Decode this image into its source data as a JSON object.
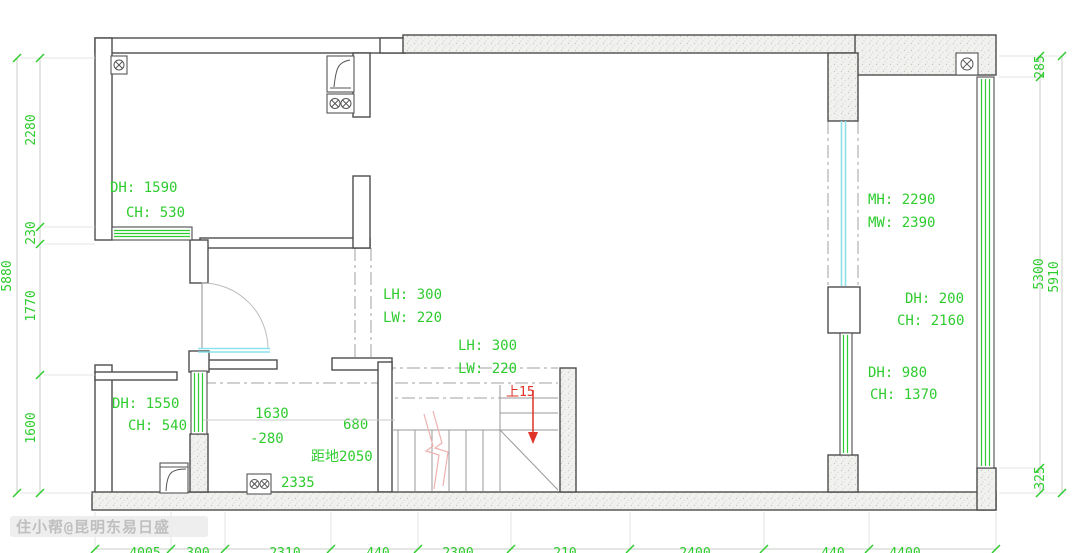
{
  "colors": {
    "annotation_green": "#2fcc2f",
    "new_window_cyan": "#8ce1ea",
    "stair_red": "#e03226",
    "break_pink": "#efb0b0",
    "wall_stroke": "#4d4d4d",
    "centerline_gray": "#a0a0a0"
  },
  "rooms": {
    "top_left_door": {
      "line1": "DH: 1590",
      "line2": "CH: 530"
    },
    "bottom_left_door": {
      "line1": "DH: 1550",
      "line2": "CH: 540"
    },
    "flue_upper": {
      "line1": "LH: 300",
      "line2": "LW: 220"
    },
    "flue_lower": {
      "line1": "LH: 300",
      "line2": "LW: 220"
    },
    "right_room_opening": {
      "line1": "MH: 2290",
      "line2": "MW: 2390"
    },
    "right_room_door_upper": {
      "line1": "DH: 200",
      "line2": "CH: 2160"
    },
    "right_room_door_lower": {
      "line1": "DH: 980",
      "line2": "CH: 1370"
    }
  },
  "notes": {
    "d1630": "1630",
    "neg280": "-280",
    "d680": "680",
    "height_note": "距地2050",
    "d2335": "2335",
    "stair_up": "上15"
  },
  "dims": {
    "left_total": "5880",
    "left_chain": [
      "2280",
      "230",
      "1770",
      "1600"
    ],
    "right_top": "285",
    "right_inner": "5300",
    "right_total": "5910",
    "right_bottom": "325",
    "bottom_chain": [
      "4005",
      "300",
      "2310",
      "440",
      "2300",
      "210",
      "2400",
      "440",
      "4400"
    ]
  },
  "watermark": "住小帮@昆明东易日盛"
}
